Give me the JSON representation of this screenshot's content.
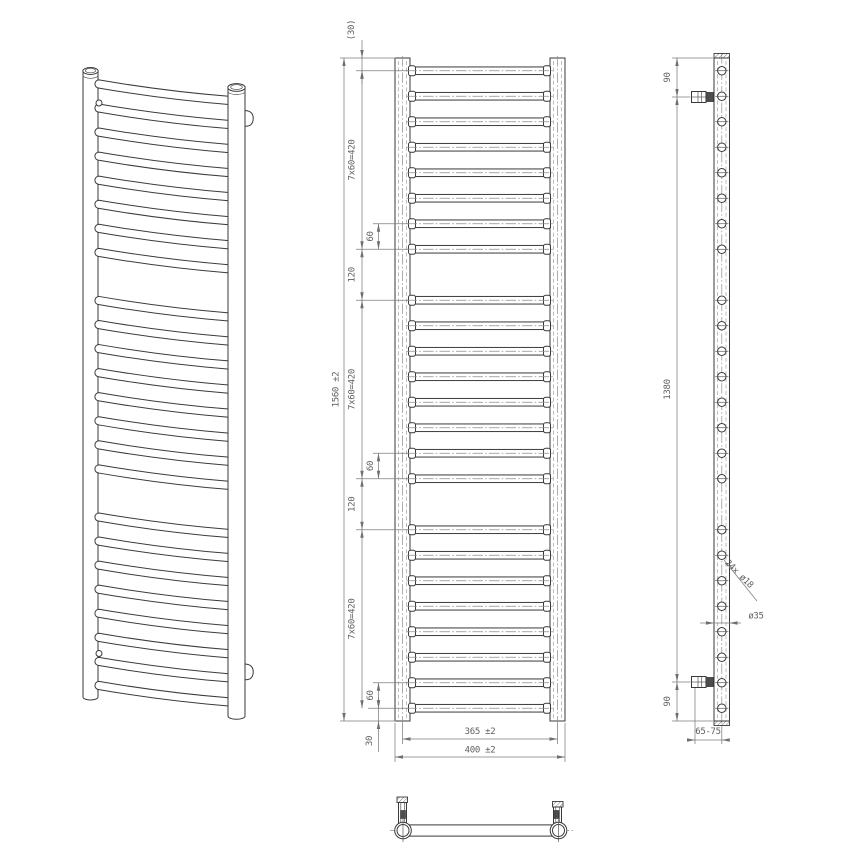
{
  "labels": {
    "front": {
      "overall_height": "1560 ±2",
      "top_offset": "(30)",
      "group_pitch": "7x60=420",
      "tube_spacing": "60",
      "group_gap": "120",
      "bottom_offset": "30",
      "rail_center_width": "365 ±2",
      "overall_width": "400 ±2"
    },
    "side": {
      "bracket_top_offset": "90",
      "bracket_span": "1380",
      "bracket_bottom_offset": "90",
      "holes_note": "24x ø18",
      "rail_diameter": "ø35",
      "wall_distance": "65-75"
    }
  },
  "geometry": {
    "tube_count": 24,
    "tube_groups": [
      8,
      8,
      8
    ],
    "tube_pitch_mm": 60,
    "group_gap_mm": 120,
    "end_offset_mm": 30,
    "overall_height_mm": 1560,
    "overall_width_mm": 400,
    "rail_axis_spacing_mm": 365,
    "rail_diameter_mm": 35,
    "tube_hole_diameter_mm": 18,
    "bracket_end_offset_mm": 90,
    "bracket_span_mm": 1380
  }
}
